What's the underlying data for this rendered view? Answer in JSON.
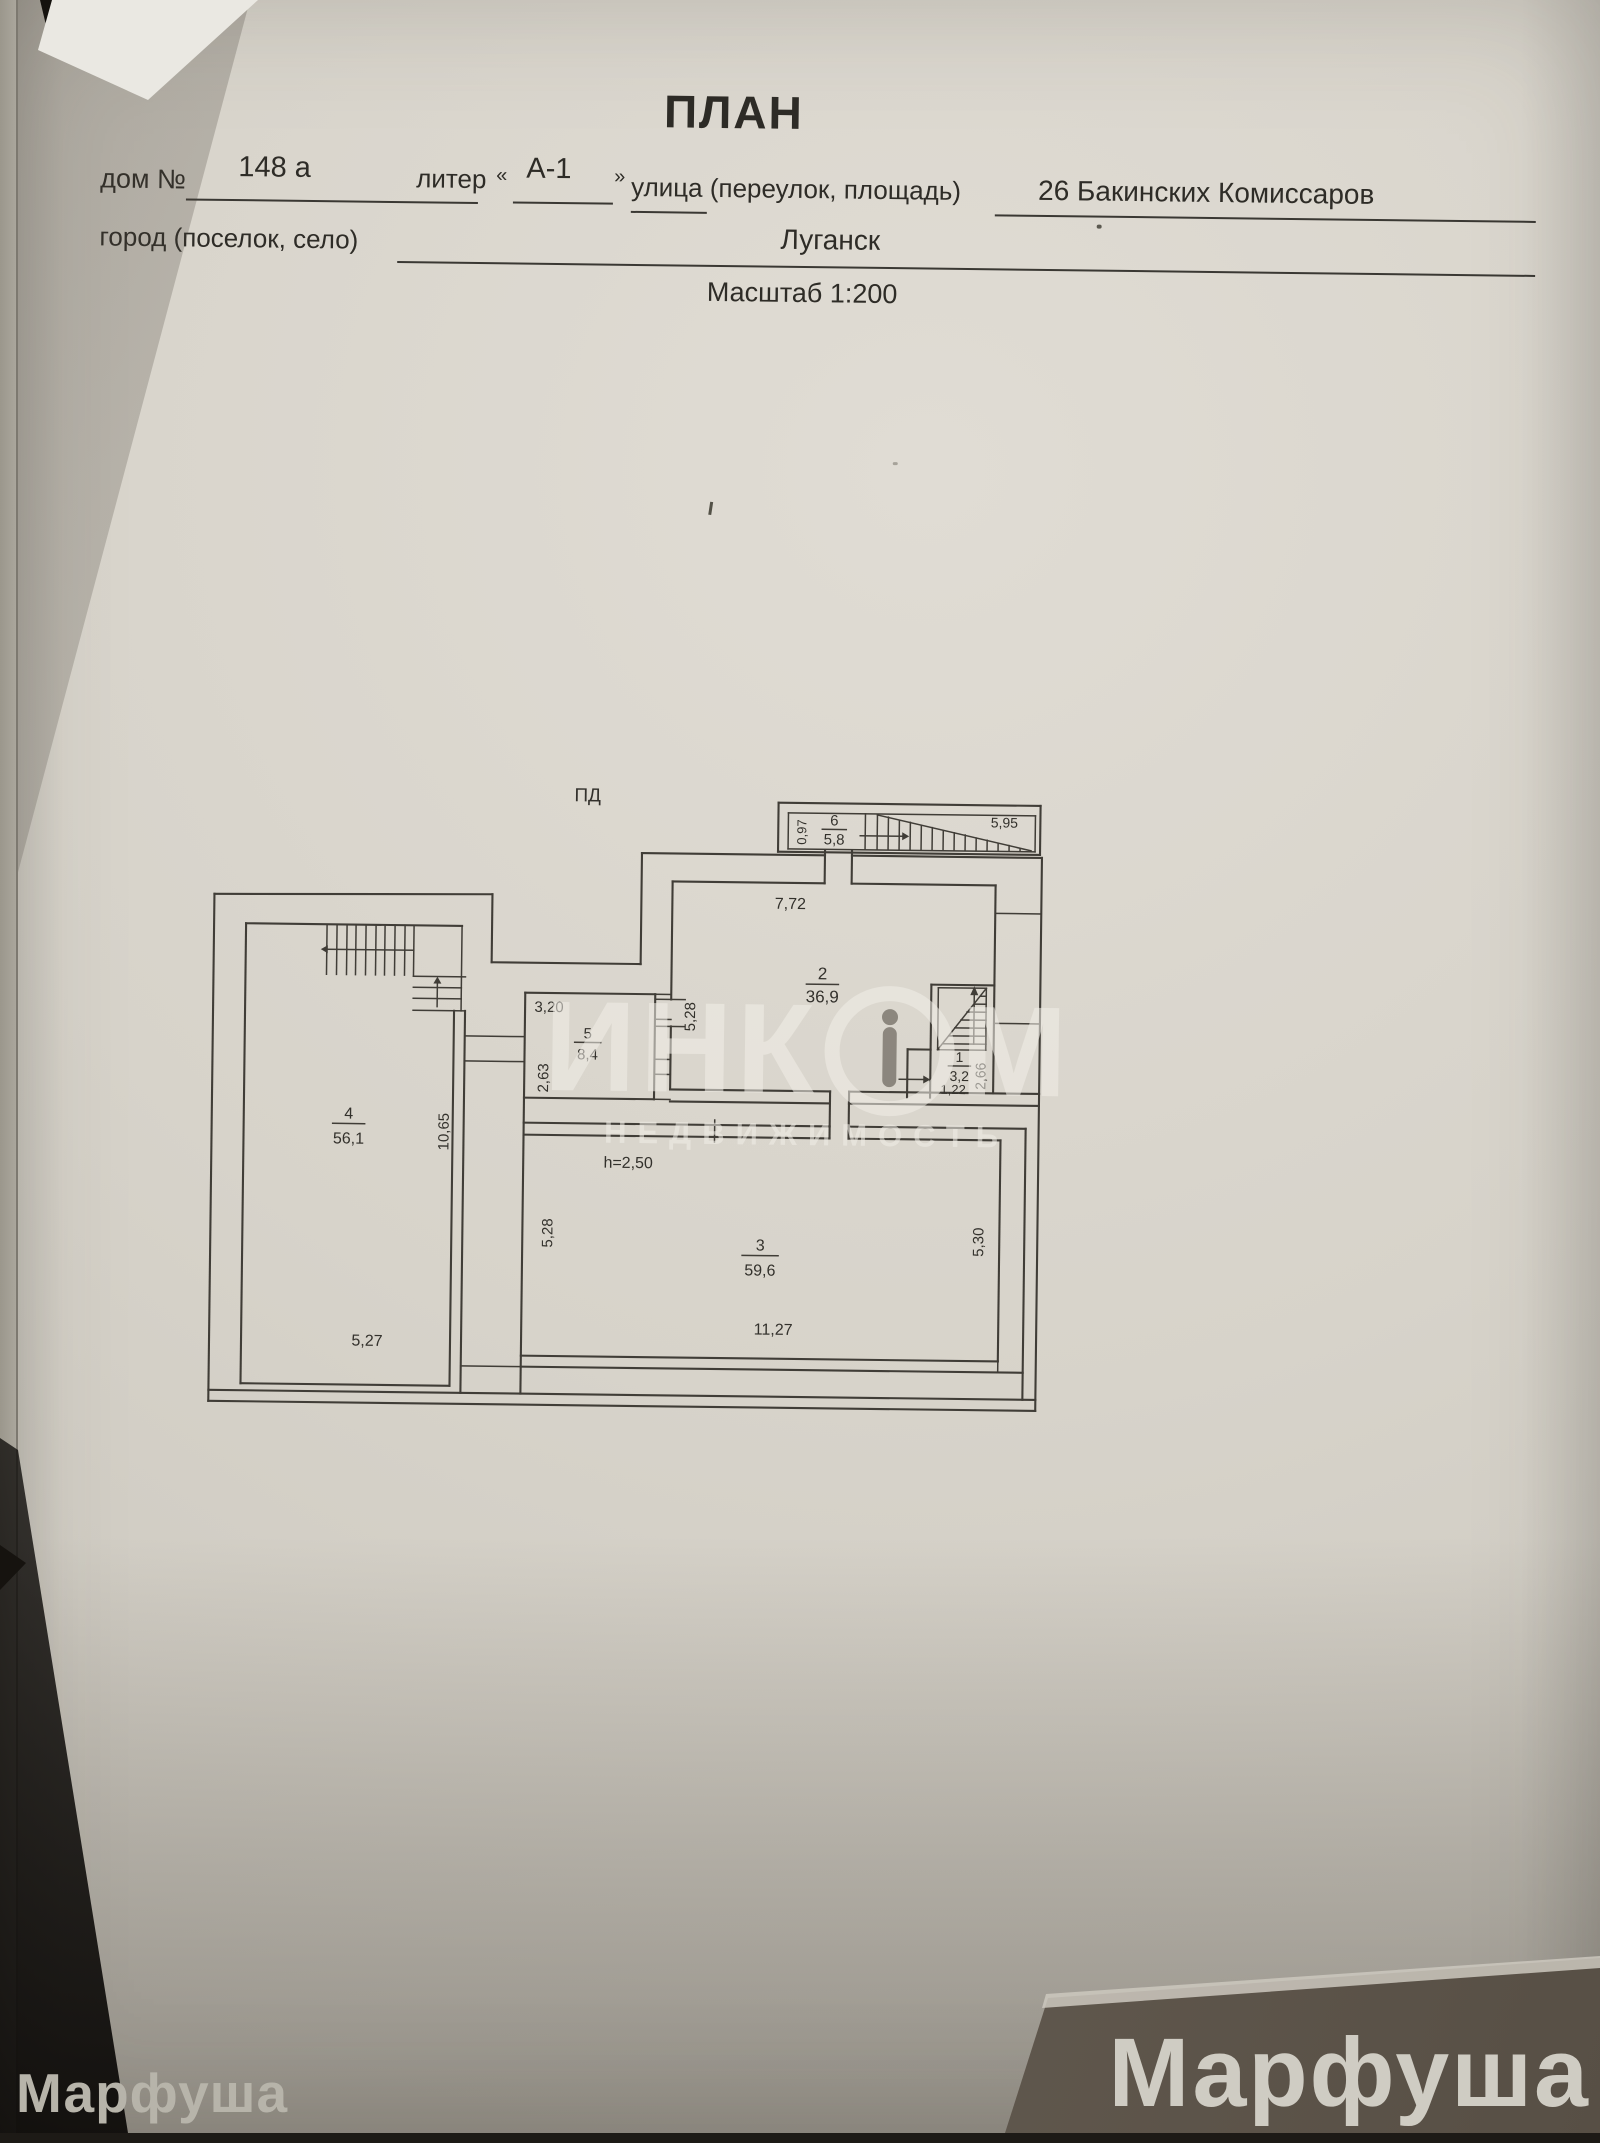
{
  "header": {
    "title": "ПЛАН",
    "house_label": "дом №",
    "house_value": "148 а",
    "liter_label": "литер",
    "liter_open": "«",
    "liter_value": "А-1",
    "liter_close": "»",
    "street_label": "улица (переулок, площадь)",
    "street_value": "26 Бакинских Комиссаров",
    "city_label": "город (поселок, село)",
    "city_value": "Луганск",
    "scale_note": "Масштаб 1:200"
  },
  "plan": {
    "section_label": "ПД",
    "annex": {
      "number": "6",
      "area": "5,8",
      "dim_width": "0,97",
      "dim_length": "5,95"
    },
    "room1": {
      "number": "1",
      "area": "3,2",
      "dim_bottom": "1,22",
      "dim_right": "2,66"
    },
    "room2": {
      "number": "2",
      "area": "36,9",
      "dim_top": "7,72",
      "dim_left": "5,28"
    },
    "room3": {
      "number": "3",
      "area": "59,6",
      "height_note": "h=2,50",
      "dim_left": "5,28",
      "dim_right": "5,30",
      "dim_bottom": "11,27"
    },
    "room4": {
      "number": "4",
      "area": "56,1",
      "dim_right": "10,65",
      "dim_bottom": "5,27"
    },
    "room5": {
      "number": "5",
      "area": "8,4",
      "dim_top": "3,20",
      "dim_left": "2,63"
    }
  },
  "watermarks": {
    "agency_name": "ИНКОМ",
    "agency_name_left": "ИНК",
    "agency_name_right": "М",
    "agency_sub": "НЕДВИЖИМОСТЬ",
    "corner_left": "Марфуша",
    "corner_right": "Марфуша"
  },
  "colors": {
    "paper": "#d7d3ca",
    "ink": "#2e2c27",
    "plan_line": "#403d37",
    "table_dark": "#6b6258"
  }
}
